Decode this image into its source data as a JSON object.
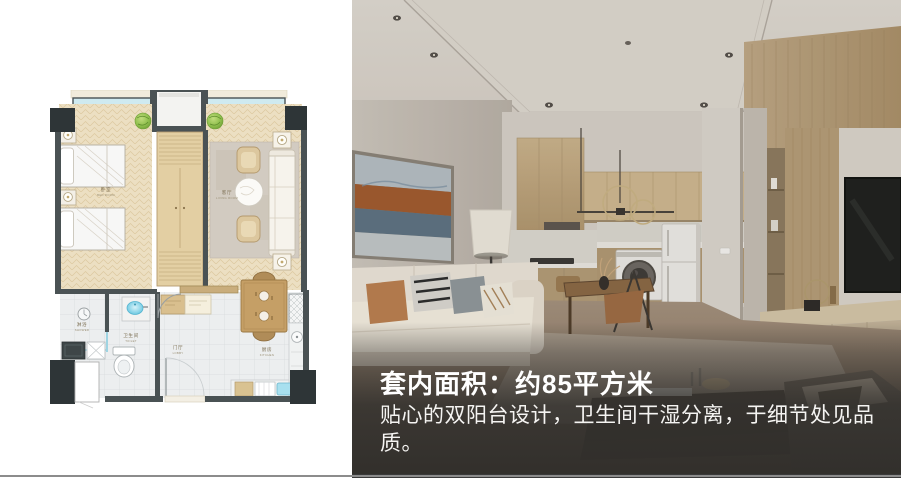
{
  "slide": {
    "floor_plan": {
      "name": "apartment-floor-plan",
      "rooms": [
        {
          "zh": "卧室",
          "en": "BED ROOM"
        },
        {
          "zh": "客厅",
          "en": "LIVING ROOM"
        },
        {
          "zh": "淋浴",
          "en": "SHOWER"
        },
        {
          "zh": "卫生间",
          "en": "TOILET"
        },
        {
          "zh": "门厅",
          "en": "LOBBY"
        },
        {
          "zh": "厨房",
          "en": "KITCHEN"
        }
      ]
    },
    "overlay": {
      "title": "套内面积：约85平方米",
      "description": "贴心的双阳台设计，卫生间干湿分离，于细节处见品质。"
    },
    "colors": {
      "wall_dark": "#4a5254",
      "column_dark": "#2e3537",
      "wood_floor": "#ecdfc2",
      "tile": "#eceeef",
      "cabinet_wood": "#e3cfa3",
      "plant_green": "#8fbf4d",
      "water_blue": "#7fd0e6",
      "overlay_bg": "#383532",
      "overlay_text": "#ffffff",
      "art_rust": "#a05a2e",
      "art_blue": "#5d7181"
    }
  }
}
